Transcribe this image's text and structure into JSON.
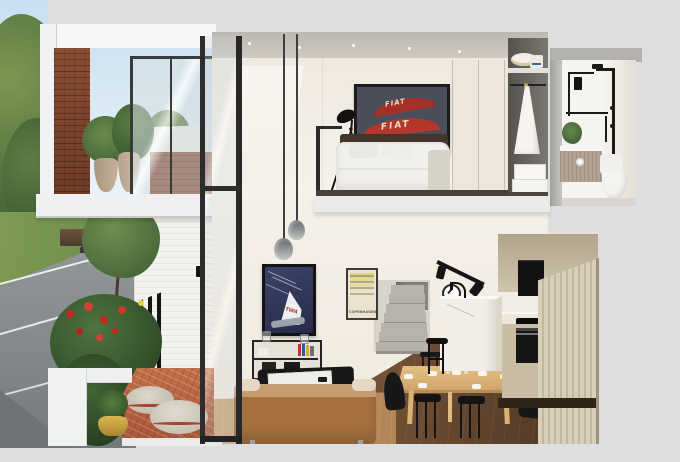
{
  "scene": {
    "title": "3D cutaway render of a two-storey loft apartment",
    "style": "dollhouse section view on a grey studio background",
    "background_color": "#dcdee0",
    "upper_floor": {
      "balcony": {
        "objects": [
          "red brick side wall",
          "glass balustrade",
          "two potted plants",
          "black framed glass sliding door",
          "sky and street trees beyond"
        ]
      },
      "bedroom": {
        "objects": [
          "double bed with white duvet",
          "dark timber headboard",
          "framed FIAT poster",
          "black tripod floor lamp",
          "built-in wardrobe sliding doors",
          "recessed ceiling downlights",
          "mezzanine balustrade"
        ]
      },
      "walk_in_robe": {
        "objects": [
          "top shelf with sun hat and bag",
          "hanging white dress",
          "two white storage boxes"
        ]
      },
      "bathroom": {
        "objects": [
          "matte black rain shower set",
          "black towel rail",
          "wall hung vanity with basin",
          "white toilet",
          "green trailing plant"
        ]
      }
    },
    "lower_floor": {
      "street": {
        "objects": [
          "asphalt road with white markings",
          "grass verge",
          "street trees",
          "parked dark car",
          "neighbouring house"
        ]
      },
      "courtyard": {
        "objects": [
          "black slat fence",
          "red flowering shrubs",
          "terracotta herringbone paving",
          "two woven floor poufs",
          "brass pot with grass plant",
          "white cut section wall"
        ]
      },
      "living_room": {
        "objects": [
          "framed TWA airline poster",
          "framed Copenhagen poster",
          "two smoked glass pendant lights",
          "black metal shelving with books",
          "black coffee table with white tray",
          "caramel fabric sofa",
          "double height glazing with black mullions"
        ]
      },
      "dining": {
        "objects": [
          "light timber dining table",
          "six black chairs",
          "white place settings",
          "small flower vase"
        ]
      },
      "kitchen": {
        "objects": [
          "white island bench with black tap",
          "black bar stool",
          "black wall oven and cooktop",
          "black integrated appliance",
          "fluted beige pantry joinery",
          "black track spotlights",
          "round wall clock"
        ]
      },
      "stairs": {
        "objects": [
          "concrete winder staircase"
        ]
      }
    },
    "posters": {
      "fiat_text": "FIAT",
      "twa_text": "TWA",
      "copenhagen_text": "COPENHAGEN"
    },
    "palette": {
      "background": "#dcdee0",
      "wall_cream": "#f3eee6",
      "ceiling_grey": "#c9c5be",
      "brick_red": "#7c432c",
      "white_brick": "#f3f2ed",
      "terracotta": "#b4613f",
      "sofa_caramel": "#a6713f",
      "timber_table": "#d9b275",
      "floor_light_wood": "#c9a274",
      "floor_dark_wood": "#5e4430",
      "fixture_black": "#161616",
      "poster_navy": "#2c3254",
      "poster_slate": "#4a4e5a",
      "poster_red": "#b5372b",
      "sky_blue": "#cfe4f2",
      "foliage_green": "#57763f",
      "flower_red": "#c0271e",
      "concrete_stair": "#b4b1ab",
      "pantry_beige": "#cfc4ac"
    }
  }
}
